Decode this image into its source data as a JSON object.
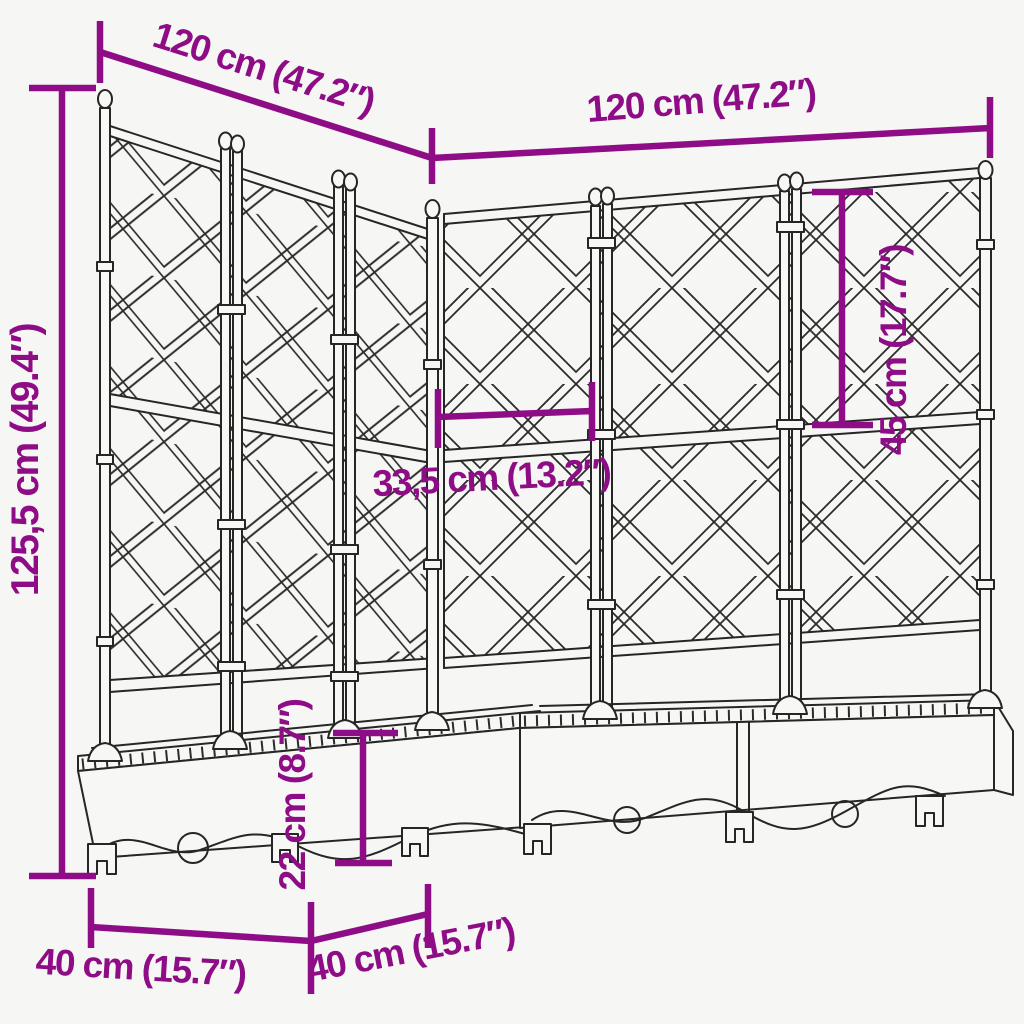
{
  "figure": {
    "background_color": "#F6F6F4",
    "line_color": "#262626",
    "dimension_color": "#8E0C86",
    "dimensions": {
      "top_left_width": "120 cm (47.2″)",
      "top_right_width": "120 cm (47.2″)",
      "total_height": "125,5 cm (49.4″)",
      "trellis_section_height": "45 cm (17.7″)",
      "panel_width": "33,5 cm (13.2″)",
      "planter_box_height": "22 cm (8.7″)",
      "depth_left": "40 cm (15.7″)",
      "depth_right": "40 cm (15.7″)"
    }
  }
}
